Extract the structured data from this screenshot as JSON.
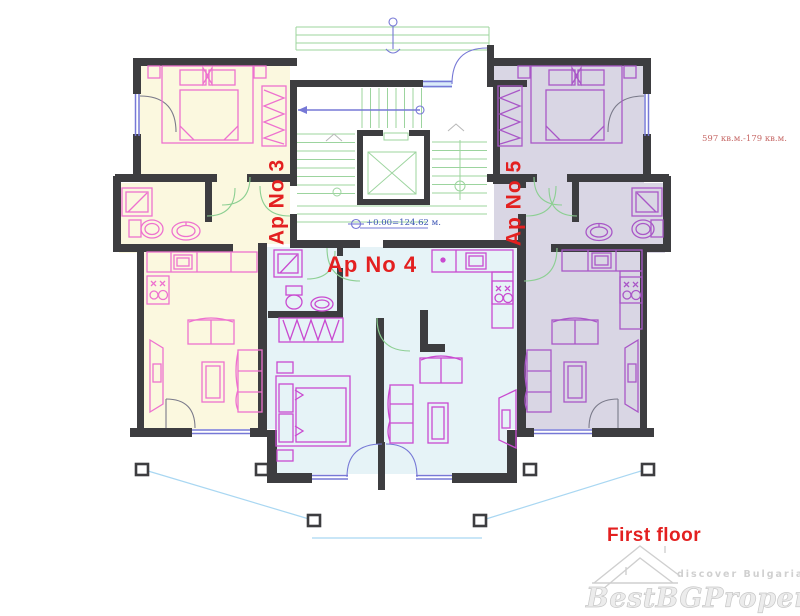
{
  "plan": {
    "apartments": [
      {
        "id": "ap3",
        "label": "Ap No 3"
      },
      {
        "id": "ap4",
        "label": "Ap No 4"
      },
      {
        "id": "ap5",
        "label": "Ap No 5"
      }
    ],
    "level_mark": "+0.00=124.62 м.",
    "area_note": "597 кв.м.-179 кв.м.",
    "floor_caption": "First floor"
  },
  "watermark": {
    "tagline": "discover Bulgaria",
    "brand": "BestBGProperties"
  },
  "colors": {
    "wall": "#3d3d40",
    "apartment3_fill": "#fbf8df",
    "apartment4_fill": "#e6f3f7",
    "apartment5_fill": "#d9d6e4",
    "furniture_pink": "#ee72cf",
    "furniture_magenta": "#c94ad0",
    "furniture_purple": "#a957c7",
    "door_green": "#8ccf92",
    "stair_green": "#9cd49e",
    "window_blue": "#7678d6",
    "terrace_blue": "#a9d7f2",
    "label_red": "#e32020",
    "area_note_red": "#c76a68",
    "level_blue": "#3c55b4",
    "watermark_gray": "#cfcfcf"
  }
}
